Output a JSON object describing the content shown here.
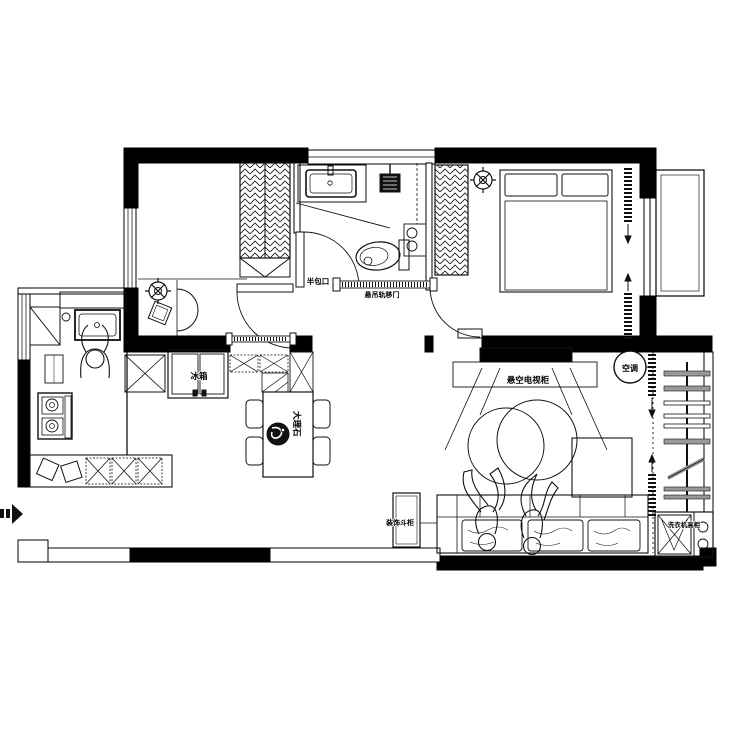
{
  "plan": {
    "type": "residential-floor-plan",
    "labels": {
      "half_wrap_opening": "半包口",
      "hanging_rail_door": "悬吊轨移门",
      "fridge": "冰箱",
      "table_material": "大理石",
      "floating_tv_cabinet": "悬空电视柜",
      "air_conditioner": "空调",
      "decorative_chest": "装饰斗柜",
      "washer_tall_cabinet": "洗衣机高柜"
    },
    "icons": {
      "ceiling_lamp": "crossed-circle",
      "entry_arrow": "right-arrow-black",
      "curtain": "coil-with-arrow",
      "drying_rack": "pole-with-bars",
      "logo_plate": "ink-drop-circle"
    },
    "colors": {
      "wall": "#000000",
      "line": "#111111",
      "background": "#ffffff",
      "rack_bar": "#999999"
    }
  }
}
